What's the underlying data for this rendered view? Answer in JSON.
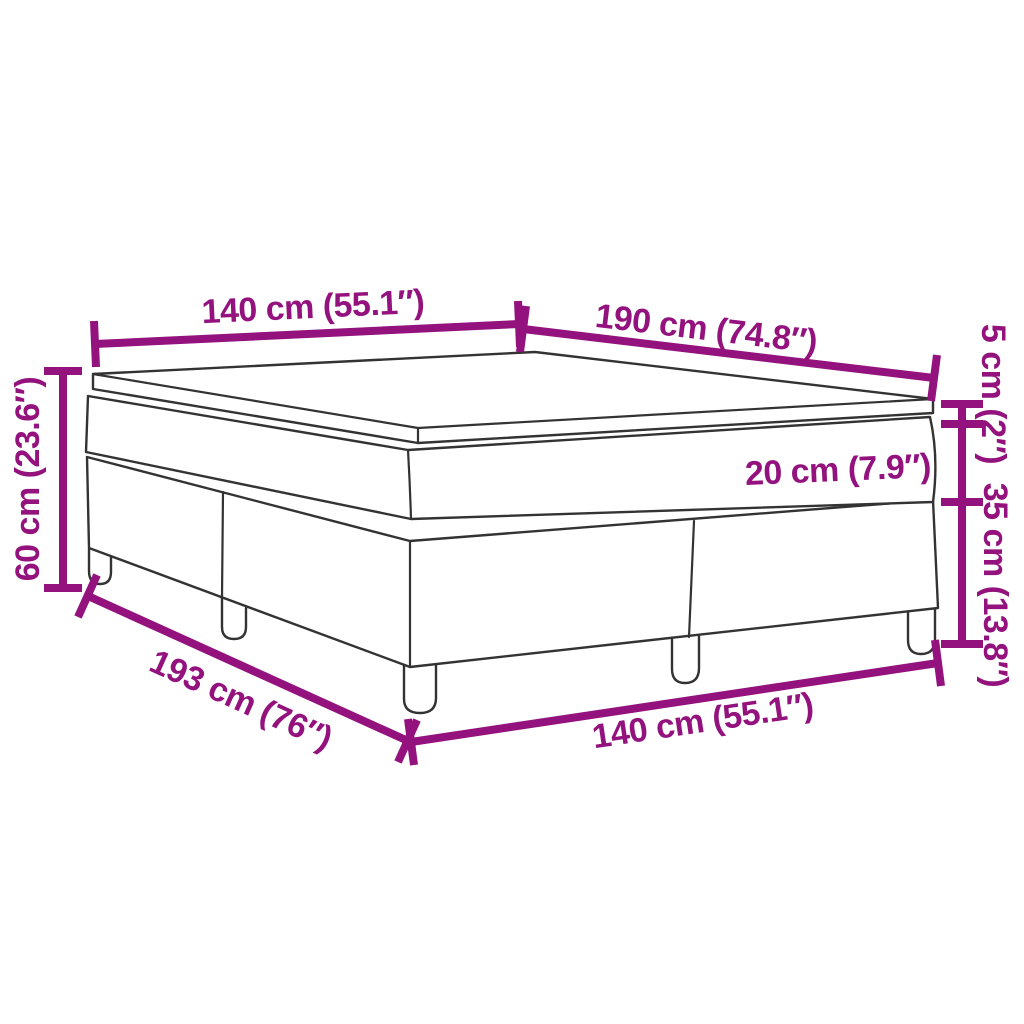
{
  "diagram": {
    "kind": "product-dimension-diagram",
    "subject": "box spring bed with mattress and topper",
    "accent_color": "#93127D",
    "outline_color": "#333333",
    "background_color": "#ffffff",
    "dimensions": {
      "top_width": "140 cm (55.1″)",
      "length": "190 cm (74.8″)",
      "topper_height": "5 cm (2″)",
      "mattress_height": "20 cm (7.9″)",
      "base_height": "35 cm (13.8″)",
      "total_height": "60 cm (23.6″)",
      "floor_depth": "193 cm (76″)",
      "bottom_width": "140 cm (55.1″)"
    }
  }
}
